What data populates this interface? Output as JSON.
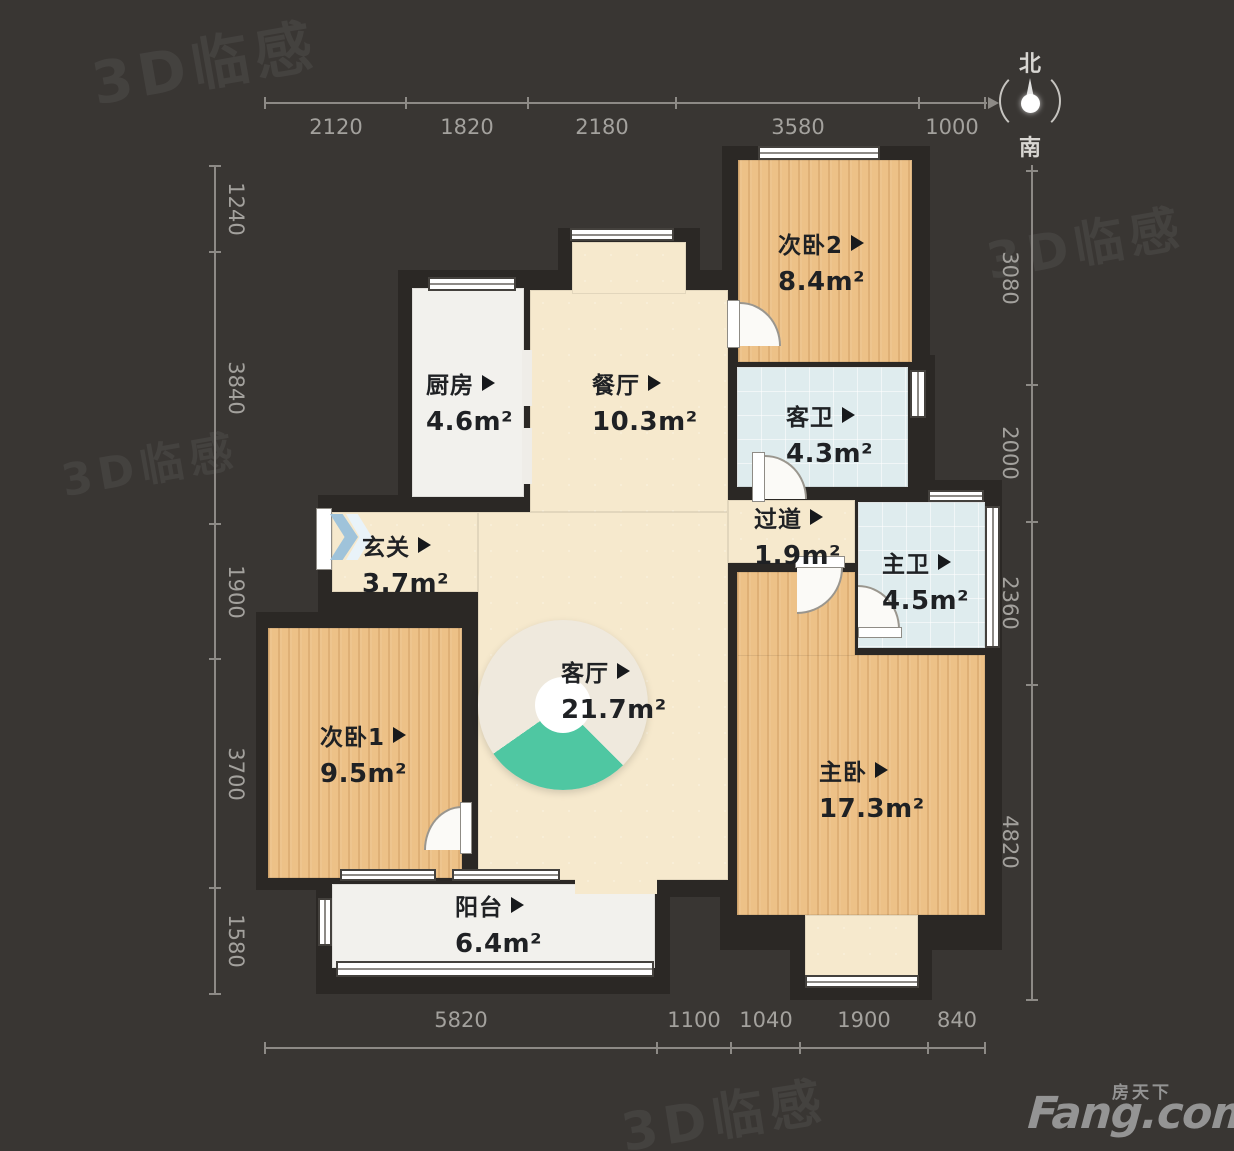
{
  "plan": {
    "rooms": [
      {
        "name": "次卧2",
        "area": "8.4m²"
      },
      {
        "name": "厨房",
        "area": "4.6m²"
      },
      {
        "name": "餐厅",
        "area": "10.3m²"
      },
      {
        "name": "客卫",
        "area": "4.3m²"
      },
      {
        "name": "过道",
        "area": "1.9m²"
      },
      {
        "name": "主卫",
        "area": "4.5m²"
      },
      {
        "name": "玄关",
        "area": "3.7m²"
      },
      {
        "name": "次卧1",
        "area": "9.5m²"
      },
      {
        "name": "客厅",
        "area": "21.7m²"
      },
      {
        "name": "主卧",
        "area": "17.3m²"
      },
      {
        "name": "阳台",
        "area": "6.4m²"
      }
    ],
    "dimensions": {
      "top": [
        "2120",
        "1820",
        "2180",
        "3580",
        "1000"
      ],
      "bottom": [
        "5820",
        "1100",
        "1040",
        "1900",
        "840"
      ],
      "left": [
        "1240",
        "3840",
        "1900",
        "3700",
        "1580"
      ],
      "right": [
        "3080",
        "2000",
        "2360",
        "4820"
      ]
    },
    "compass": {
      "north": "北",
      "south": "南"
    },
    "watermark": "3D临感",
    "logo": {
      "cn": "房天下",
      "en": "Fang.com"
    },
    "colors": {
      "wood": "#edc187",
      "cream": "#f6e9cd",
      "tile": "#dfecee",
      "white_floor": "#f2f1ed",
      "wall": "#2b2825",
      "background": "#393633",
      "pie_accent": "#4fc7a2"
    }
  }
}
